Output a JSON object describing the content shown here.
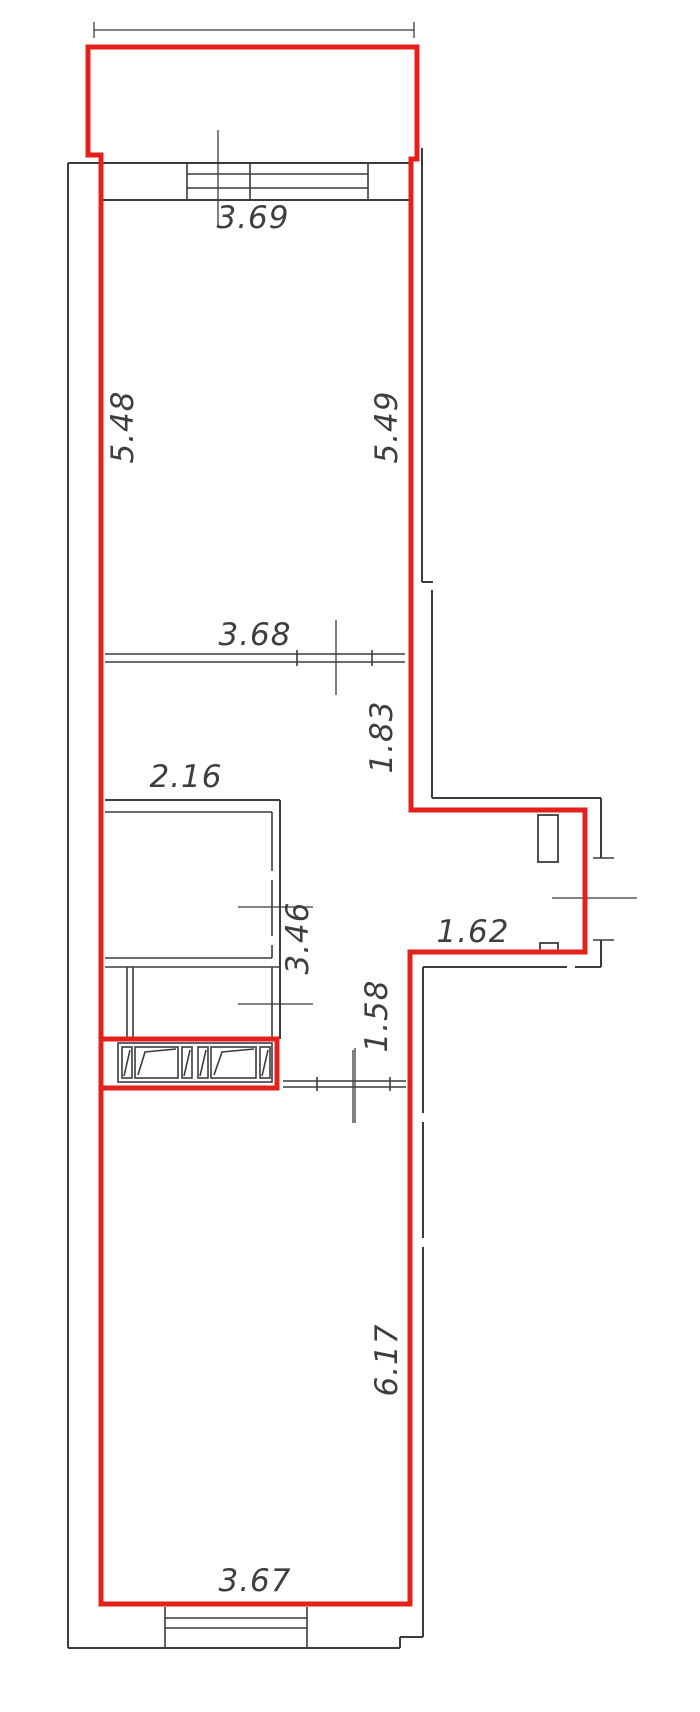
{
  "drawing": {
    "type": "apartment-floor-plan",
    "unit_boundary_color_meaning": "red outline marks the apartment unit walls",
    "colors": {
      "wall_red": "#e3211a",
      "line_dark": "#3b3b40",
      "label_text": "#3d3d42",
      "background": "#ffffff"
    }
  },
  "dimensions": {
    "d369": {
      "value": "3.69"
    },
    "d548": {
      "value": "5.48"
    },
    "d549": {
      "value": "5.49"
    },
    "d368": {
      "value": "3.68"
    },
    "d183": {
      "value": "1.83"
    },
    "d216": {
      "value": "2.16"
    },
    "d346": {
      "value": "3.46"
    },
    "d162": {
      "value": "1.62"
    },
    "d158": {
      "value": "1.58"
    },
    "d617": {
      "value": "6.17"
    },
    "d367": {
      "value": "3.67"
    }
  }
}
